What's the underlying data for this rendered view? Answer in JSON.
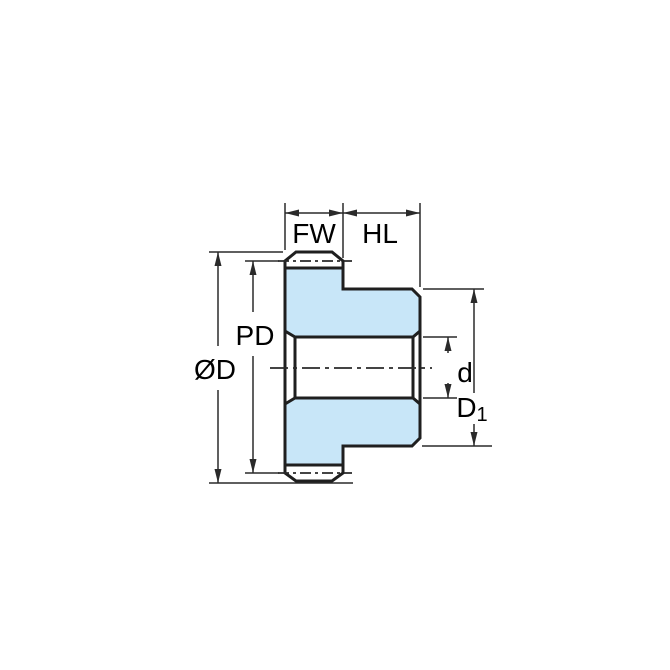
{
  "diagram": {
    "description": "Spur gear with hub - cross-section dimension drawing",
    "labels": {
      "face_width": "FW",
      "hub_length": "HL",
      "pitch_diameter": "PD",
      "outside_diameter": "ØD",
      "bore_diameter": "d",
      "hub_diameter_main": "D",
      "hub_diameter_sub": "1"
    },
    "colors": {
      "part_fill": "#c8e6f8",
      "part_outline": "#1f1f1f",
      "dimension_line": "#2a2a2a",
      "label_text": "#000000",
      "background": "#ffffff"
    }
  }
}
